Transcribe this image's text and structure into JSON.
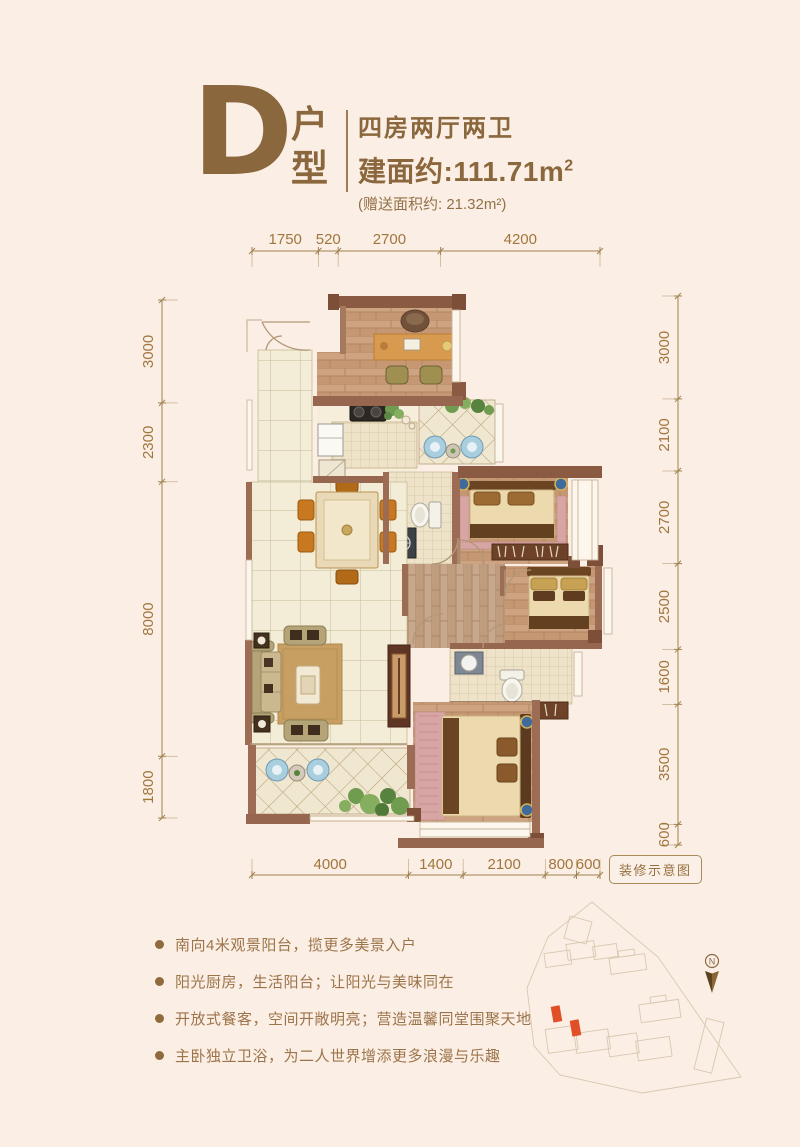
{
  "page": {
    "background": "#fbeee4",
    "accent": "#8f6a3d"
  },
  "header": {
    "plan_letter": "D",
    "plan_type_chars": [
      "户",
      "型"
    ],
    "layout": "四房两厅两卫",
    "area_label": "建面约:111.71m",
    "area_sup": "2",
    "bonus_area": "(赠送面积约: 21.32m²)"
  },
  "floorplan": {
    "dimensions_mm": {
      "top": [
        "1750",
        "520",
        "2700",
        "4200"
      ],
      "left": [
        "3000",
        "2300",
        "8000",
        "1800"
      ],
      "right": [
        "3000",
        "2100",
        "2700",
        "2500",
        "1600",
        "3500",
        "600"
      ],
      "bottom": [
        "4000",
        "1400",
        "2100",
        "800",
        "600"
      ]
    },
    "note_badge": "装修示意图"
  },
  "features": {
    "items": [
      "南向4米观景阳台，揽更多美景入户",
      "阳光厨房，生活阳台；让阳光与美味同在",
      "开放式餐客，空间开敞明亮；营造温馨同堂围聚天地",
      "主卧独立卫浴，为二人世界增添更多浪漫与乐趣"
    ]
  },
  "siteplan": {
    "compass_label": "N"
  }
}
